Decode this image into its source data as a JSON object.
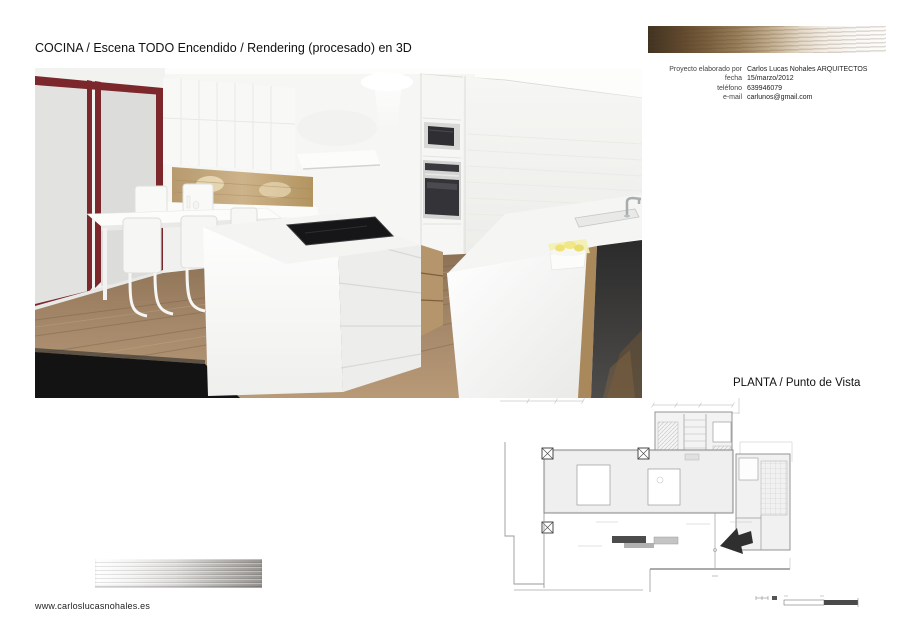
{
  "page": {
    "title": "COCINA / Escena TODO Encendido / Rendering (procesado) en 3D",
    "plan_title": "PLANTA / Punto de Vista",
    "website": "www.carloslucasnohales.es"
  },
  "project_info": {
    "rows": [
      {
        "label": "Proyecto elaborado por",
        "value": "Carlos Lucas Nohales ARQUITECTOS"
      },
      {
        "label": "fecha",
        "value": "15/marzo/2012"
      },
      {
        "label": "teléfono",
        "value": "639946079"
      },
      {
        "label": "e-mail",
        "value": "carlunos@gmail.com"
      }
    ]
  },
  "render": {
    "subject": "kitchen-3d-rendering",
    "elements": [
      "sliding-door-burgundy",
      "dining-table-white",
      "cantilever-chairs",
      "upper-cabinets",
      "wood-backsplash",
      "extractor-hood",
      "oven-column",
      "kitchen-island",
      "induction-cooktop",
      "peninsula-counter",
      "sink-faucet",
      "lemons-bowl",
      "wood-floor",
      "dark-rug",
      "dishwasher-panel"
    ]
  },
  "plan": {
    "subject": "floor-plan-with-viewpoint",
    "marker": "viewpoint-arrow"
  },
  "colors": {
    "door_frame": "#7c272b",
    "wood_bar_dark": "#3f3321",
    "silver_bar": "#989591",
    "wood_backsplash": "#c3a87e",
    "floor_wood": "#9c7f5f",
    "cooktop": "#161618",
    "arrow": "#2f2f2f",
    "text": "#1a1a1a"
  }
}
